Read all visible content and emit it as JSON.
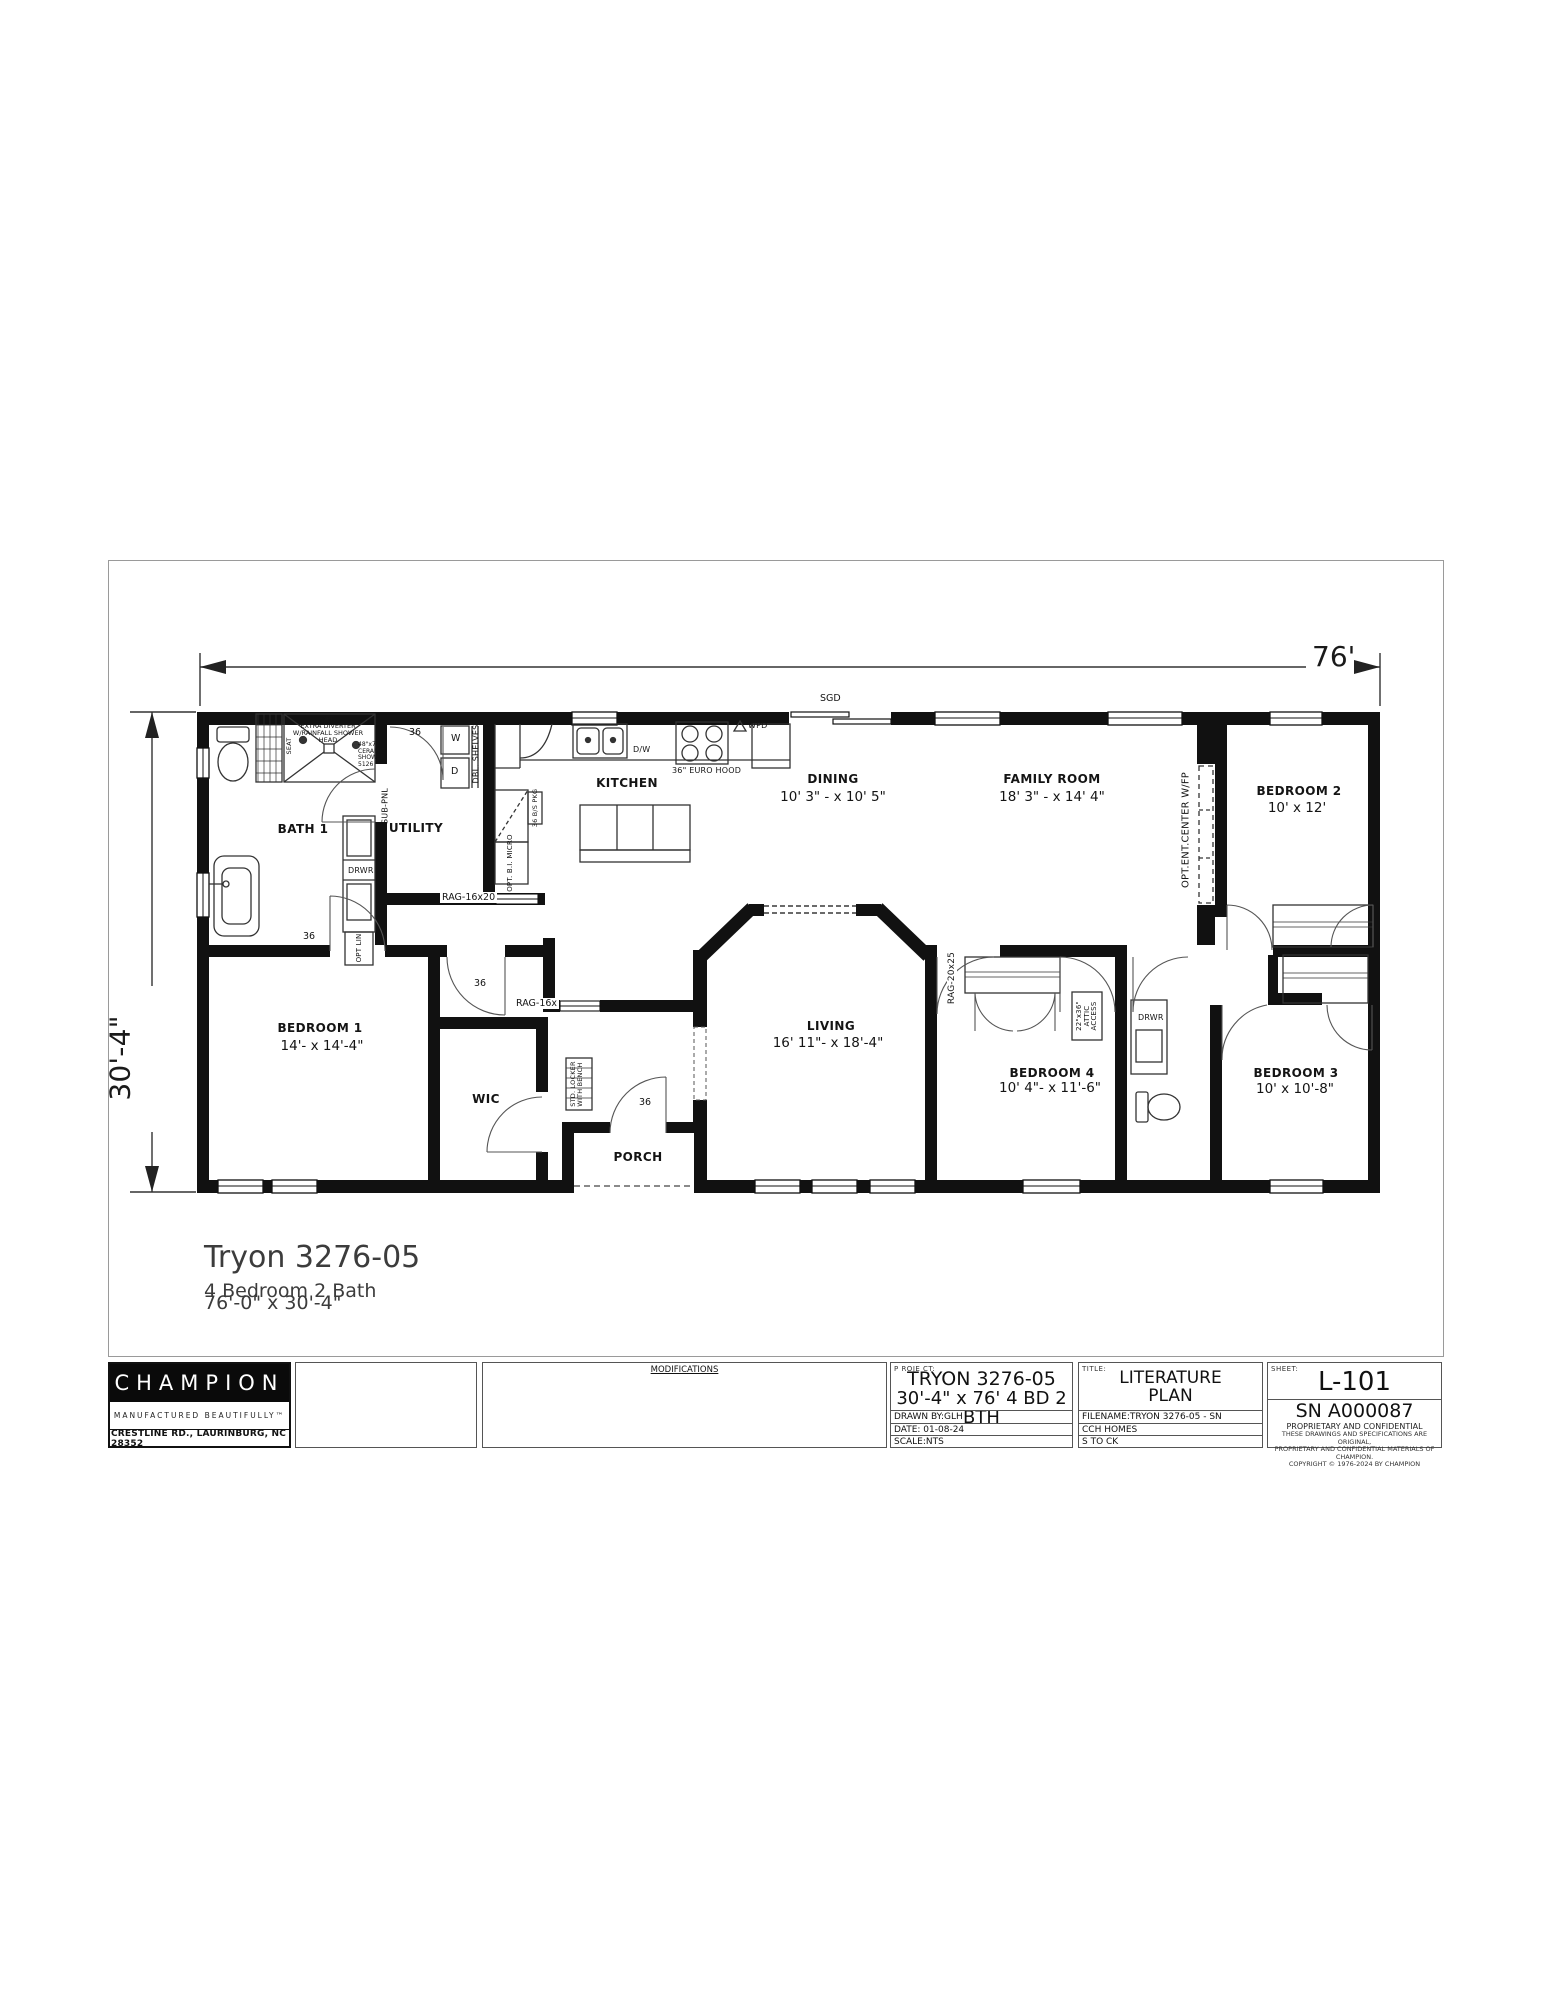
{
  "drawing": {
    "dim_width": "76'",
    "dim_depth": "30'-4\"",
    "rooms": {
      "bath1": {
        "name": "BATH 1"
      },
      "utility": {
        "name": "UTILITY"
      },
      "kitchen": {
        "name": "KITCHEN"
      },
      "dining": {
        "name": "DINING",
        "dims": "10' 3\" - x 10' 5\""
      },
      "family": {
        "name": "FAMILY ROOM",
        "dims": "18' 3\" - x 14' 4\""
      },
      "bedroom2": {
        "name": "BEDROOM 2",
        "dims": "10' x 12'"
      },
      "bedroom1": {
        "name": "BEDROOM 1",
        "dims": "14'- x 14'-4\""
      },
      "wic": {
        "name": "WIC"
      },
      "living": {
        "name": "LIVING",
        "dims": "16' 11\"- x 18'-4\""
      },
      "bedroom4": {
        "name": "BEDROOM 4",
        "dims": "10' 4\"- x 11'-6\""
      },
      "bedroom3": {
        "name": "BEDROOM 3",
        "dims": "10' x 10'-8\""
      },
      "porch": {
        "name": "PORCH"
      }
    },
    "annotations": {
      "sgd": "SGD",
      "wpd": "WPD",
      "euro_hood": "36\" EURO HOOD",
      "dw": "D/W",
      "washer": "W",
      "dryer": "D",
      "dbl_shelves": "DBL. SHELVES",
      "sub_pnl": "SUB-PNL",
      "drwr": "DRWR",
      "opt_lin": "OPT LIN",
      "opt_bi_micro": "OPT. B.I. MICRO",
      "bs_pkg": "36 B/S PKG",
      "seat": "SEAT",
      "shower_l1": "OPT.",
      "shower_l2": "EXTRA DIVERTER",
      "shower_l3": "W/RAINFALL SHOWER",
      "shower_l4": "HEAD",
      "shower_spec1": "48\"x72\"",
      "shower_spec2": "CERAMIC",
      "shower_spec3": "SHOWER",
      "shower_spec4": "5126",
      "rag_16x20": "RAG-16x20",
      "rag_16x": "RAG-16x",
      "rag_20x25": "RAG-20x25",
      "opt_ent_center": "OPT.ENT.CENTER W/FP",
      "attic": "22\"x36\" ATTIC ACCESS",
      "locker_l1": "STD. LOCKER",
      "locker_l2": "WITH BENCH",
      "door36": "36"
    },
    "callout": {
      "model": "Tryon 3276-05",
      "line2": "4 Bedroom 2 Bath",
      "line3": "76'-0\" x 30'-4\""
    }
  },
  "titleblock": {
    "champion": {
      "logo": "CHAMPION",
      "tagline": "MANUFACTURED BEAUTIFULLY™",
      "address": "CRESTLINE RD., LAURINBURG, NC 28352"
    },
    "modifications_label": "MODIFICATIONS",
    "project": {
      "label": "P ROJE CT:",
      "name": "TRYON 3276-05",
      "spec": "30'-4\" x 76' 4 BD 2 BTH",
      "drawn_by": "DRAWN  BY:GLH",
      "date": "DATE: 01-08-24",
      "scale": "SCALE:NTS"
    },
    "title": {
      "label": "TITLE:",
      "line1": "LITERATURE",
      "line2": "PLAN",
      "filename": "FILENAME:TRYON 3276-05 - SN A000087 UPDATED LIT",
      "row2": "CCH HOMES",
      "row3": "S TO CK"
    },
    "sheet": {
      "label": "SHEET:",
      "number": "L-101",
      "serial": "SN A000087",
      "conf": "PROPRIETARY AND CONFIDENTIAL",
      "fine1": "THESE DRAWINGS AND SPECIFICATIONS ARE ORIGINAL,",
      "fine2": "PROPRIETARY AND CONFIDENTIAL MATERIALS OF CHAMPION.",
      "fine3": "COPYRIGHT © 1976-2024 BY CHAMPION"
    }
  }
}
